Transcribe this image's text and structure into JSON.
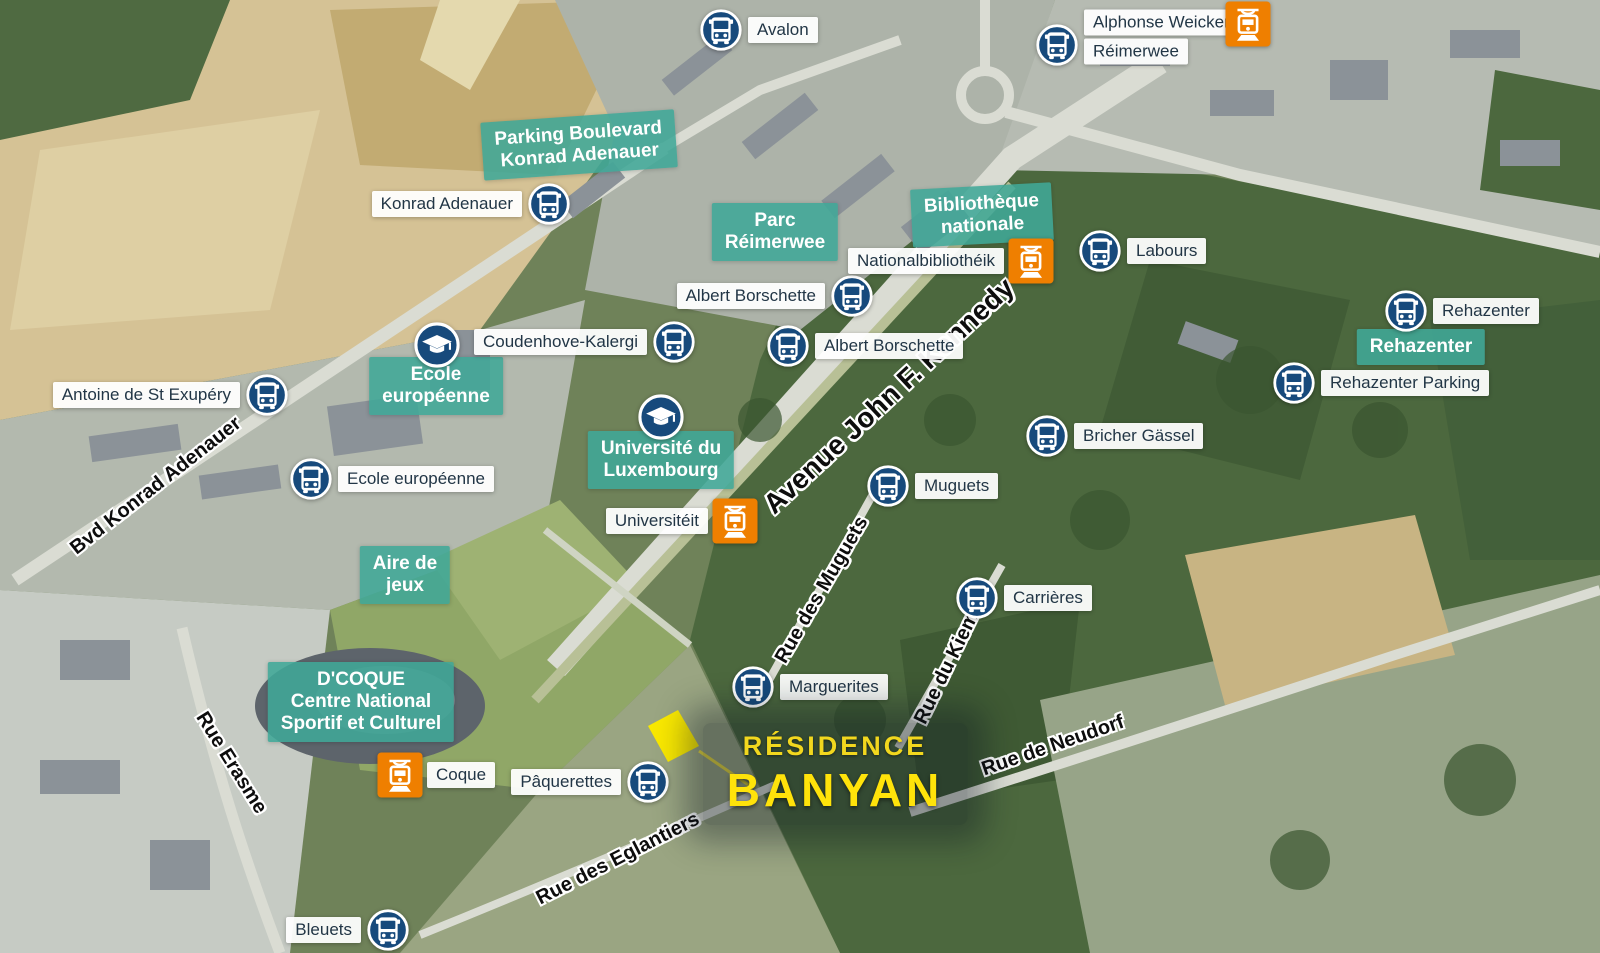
{
  "canvas": {
    "width": 1600,
    "height": 953
  },
  "colors": {
    "bus_icon_navy": "#174a7c",
    "tram_icon_orange": "#ef7f00",
    "poi_label_teal": "rgba(64,167,151,0.88)",
    "stop_pill_bg": "rgba(255,255,255,0.94)",
    "stop_pill_text": "#223646",
    "street_text": "#0d0d0d",
    "residence_yellow": "#ffe30a",
    "plot_yellow": "#f9e800"
  },
  "icons": {
    "bus": "bus-icon",
    "tram": "tram-icon",
    "education": "graduation-cap-icon"
  },
  "markers": {
    "bus_stops": [
      {
        "label": "Avalon",
        "x": 721,
        "y": 30,
        "side": "right"
      },
      {
        "labels": [
          "Alphonse Weicker",
          "Réimerwee"
        ],
        "x": 1057,
        "y": 45,
        "side": "right",
        "dy": -8
      },
      {
        "label": "Konrad Adenauer",
        "x": 549,
        "y": 204,
        "side": "left"
      },
      {
        "label": "Labours",
        "x": 1100,
        "y": 251,
        "side": "right"
      },
      {
        "label": "Albert Borschette",
        "x": 852,
        "y": 296,
        "side": "left"
      },
      {
        "label": "Coudenhove-Kalergi",
        "x": 674,
        "y": 342,
        "side": "left"
      },
      {
        "label": "Albert Borschette",
        "x": 788,
        "y": 346,
        "side": "right"
      },
      {
        "label": "Antoine de St Exupéry",
        "x": 267,
        "y": 395,
        "side": "left"
      },
      {
        "label": "Ecole européenne",
        "x": 311,
        "y": 479,
        "side": "right"
      },
      {
        "label": "Bricher Gässel",
        "x": 1047,
        "y": 436,
        "side": "right"
      },
      {
        "label": "Muguets",
        "x": 888,
        "y": 486,
        "side": "right"
      },
      {
        "label": "Carrières",
        "x": 977,
        "y": 598,
        "side": "right"
      },
      {
        "label": "Marguerites",
        "x": 753,
        "y": 687,
        "side": "right"
      },
      {
        "label": "Pâquerettes",
        "x": 648,
        "y": 782,
        "side": "left"
      },
      {
        "label": "Bleuets",
        "x": 388,
        "y": 930,
        "side": "left"
      },
      {
        "label": "Rehazenter",
        "x": 1406,
        "y": 311,
        "side": "right"
      },
      {
        "label": "Rehazenter Parking",
        "x": 1294,
        "y": 383,
        "side": "right"
      }
    ],
    "tram_stops": [
      {
        "label": "",
        "x": 1248,
        "y": 24,
        "side": "left"
      },
      {
        "label": "Nationalbibliothéik",
        "x": 1031,
        "y": 261,
        "side": "left"
      },
      {
        "label": "Universitéit",
        "x": 735,
        "y": 521,
        "side": "left"
      },
      {
        "label": "Coque",
        "x": 400,
        "y": 775,
        "side": "right"
      }
    ],
    "education_icons": [
      {
        "x": 437,
        "y": 345
      },
      {
        "x": 661,
        "y": 417
      }
    ]
  },
  "poi_labels": [
    {
      "lines": [
        "Parking Boulevard",
        "Konrad Adenauer"
      ],
      "x": 579,
      "y": 145,
      "angle": -4
    },
    {
      "lines": [
        "Parc",
        "Réimerwee"
      ],
      "x": 775,
      "y": 232,
      "angle": 0
    },
    {
      "lines": [
        "Bibliothèque",
        "nationale"
      ],
      "x": 982,
      "y": 215,
      "angle": -3
    },
    {
      "lines": [
        "Ecole",
        "européenne"
      ],
      "x": 436,
      "y": 386,
      "angle": 0
    },
    {
      "lines": [
        "Université du",
        "Luxembourg"
      ],
      "x": 661,
      "y": 460,
      "angle": 0
    },
    {
      "lines": [
        "Aire de",
        "jeux"
      ],
      "x": 405,
      "y": 575,
      "angle": 0
    },
    {
      "lines": [
        "Rehazenter"
      ],
      "x": 1421,
      "y": 347,
      "angle": 0
    },
    {
      "lines": [
        "D'COQUE",
        "Centre National",
        "Sportif et Culturel"
      ],
      "x": 361,
      "y": 702,
      "angle": 0
    }
  ],
  "street_names": [
    {
      "name": "Avenue John F. Kennedy",
      "x": 889,
      "y": 396,
      "angle": -43,
      "size": 28
    },
    {
      "name": "Bvd Konrad Adenauer",
      "x": 156,
      "y": 486,
      "angle": -38,
      "size": 20
    },
    {
      "name": "Rue Erasme",
      "x": 231,
      "y": 763,
      "angle": 58,
      "size": 20
    },
    {
      "name": "Rue des Muguets",
      "x": 822,
      "y": 590,
      "angle": -60,
      "size": 20
    },
    {
      "name": "Rue du Kiem",
      "x": 947,
      "y": 668,
      "angle": -64,
      "size": 20
    },
    {
      "name": "Rue de Neudorf",
      "x": 1053,
      "y": 746,
      "angle": -19,
      "size": 20
    },
    {
      "name": "Rue des Eglantiers",
      "x": 618,
      "y": 859,
      "angle": -27,
      "size": 20
    }
  ],
  "residence": {
    "line1": "RÉSIDENCE",
    "line2": "BANYAN",
    "x": 835,
    "y": 774,
    "plot_points": "678,710 699,746 668,762 648,726",
    "pointer": {
      "x1": 699,
      "y1": 751,
      "x2": 750,
      "y2": 786
    }
  }
}
